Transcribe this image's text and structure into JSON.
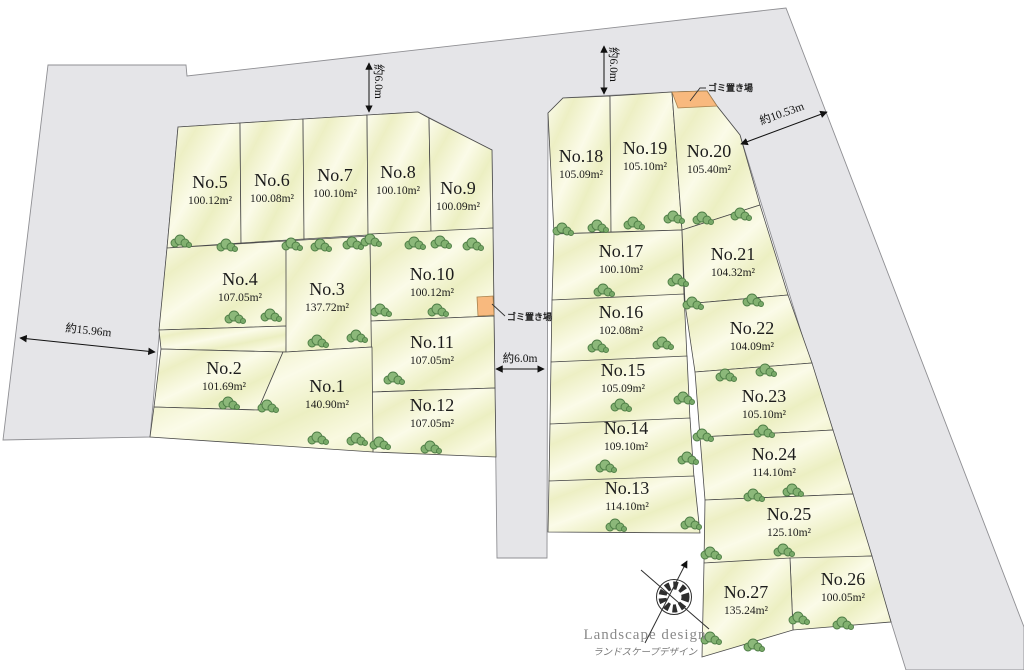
{
  "lots": [
    {
      "no": "No.1",
      "area": "140.90m²"
    },
    {
      "no": "No.2",
      "area": "101.69m²"
    },
    {
      "no": "No.3",
      "area": "137.72m²"
    },
    {
      "no": "No.4",
      "area": "107.05m²"
    },
    {
      "no": "No.5",
      "area": "100.12m²"
    },
    {
      "no": "No.6",
      "area": "100.08m²"
    },
    {
      "no": "No.7",
      "area": "100.10m²"
    },
    {
      "no": "No.8",
      "area": "100.10m²"
    },
    {
      "no": "No.9",
      "area": "100.09m²"
    },
    {
      "no": "No.10",
      "area": "100.12m²"
    },
    {
      "no": "No.11",
      "area": "107.05m²"
    },
    {
      "no": "No.12",
      "area": "107.05m²"
    },
    {
      "no": "No.13",
      "area": "114.10m²"
    },
    {
      "no": "No.14",
      "area": "109.10m²"
    },
    {
      "no": "No.15",
      "area": "105.09m²"
    },
    {
      "no": "No.16",
      "area": "102.08m²"
    },
    {
      "no": "No.17",
      "area": "100.10m²"
    },
    {
      "no": "No.18",
      "area": "105.09m²"
    },
    {
      "no": "No.19",
      "area": "105.10m²"
    },
    {
      "no": "No.20",
      "area": "105.40m²"
    },
    {
      "no": "No.21",
      "area": "104.32m²"
    },
    {
      "no": "No.22",
      "area": "104.09m²"
    },
    {
      "no": "No.23",
      "area": "105.10m²"
    },
    {
      "no": "No.24",
      "area": "114.10m²"
    },
    {
      "no": "No.25",
      "area": "125.10m²"
    },
    {
      "no": "No.26",
      "area": "100.05m²"
    },
    {
      "no": "No.27",
      "area": "135.24m²"
    }
  ],
  "dimensions": {
    "left_road": "約15.96m",
    "top_road_left": "約6.0m",
    "top_road_right": "約6.0m",
    "center_road": "約6.0m",
    "right_road": "約10.53m"
  },
  "labels": {
    "garbage": "ゴミ置き場"
  },
  "branding": {
    "en": "Landscape design",
    "ja": "ランドスケープデザイン"
  },
  "colors": {
    "road": "#e5e5e8",
    "lot_border": "#4a4a4a",
    "garbage": "#f8b97e",
    "tree": "#82b170"
  }
}
